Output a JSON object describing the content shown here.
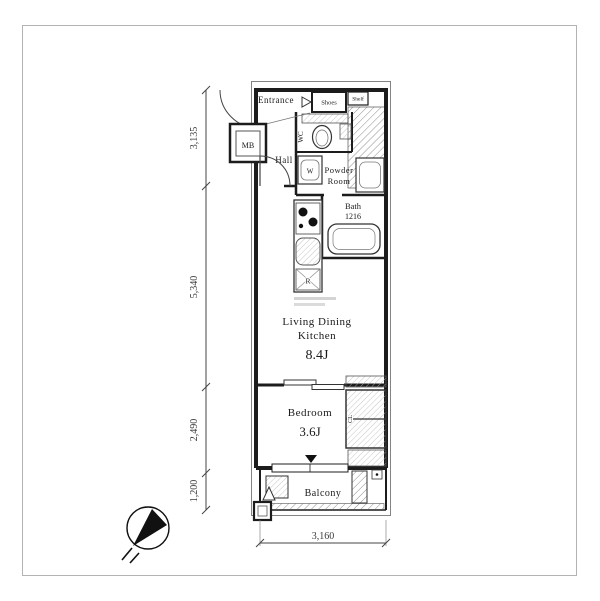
{
  "page": {
    "type": "apartment-floor-plan",
    "background": "#ffffff"
  },
  "labels": {
    "entrance": "Entrance",
    "shoes": "Shoes",
    "shelf": "Shelf",
    "meter_box": "MB",
    "hall": "Hall",
    "wc": "WC",
    "washbasin": "W",
    "powder_room_line1": "Powder",
    "powder_room_line2": "Room",
    "bath": "Bath",
    "bath_size": "1216",
    "refrigerator": "R",
    "ldk_line1": "Living Dining",
    "ldk_line2": "Kitchen",
    "ldk_size": "8.4J",
    "bedroom": "Bedroom",
    "bedroom_size": "3.6J",
    "closet": "CL",
    "balcony": "Balcony"
  },
  "dimensions": {
    "left": [
      "3,135",
      "5,340",
      "2,490",
      "1,200"
    ],
    "bottom": "3,160"
  },
  "icons": {
    "compass": "north-arrow-icon"
  },
  "colors": {
    "wall": "#1c1c1c",
    "hatch": "#8f8f8f",
    "text": "#1a1a1a",
    "dimension": "#3a3a3a"
  }
}
